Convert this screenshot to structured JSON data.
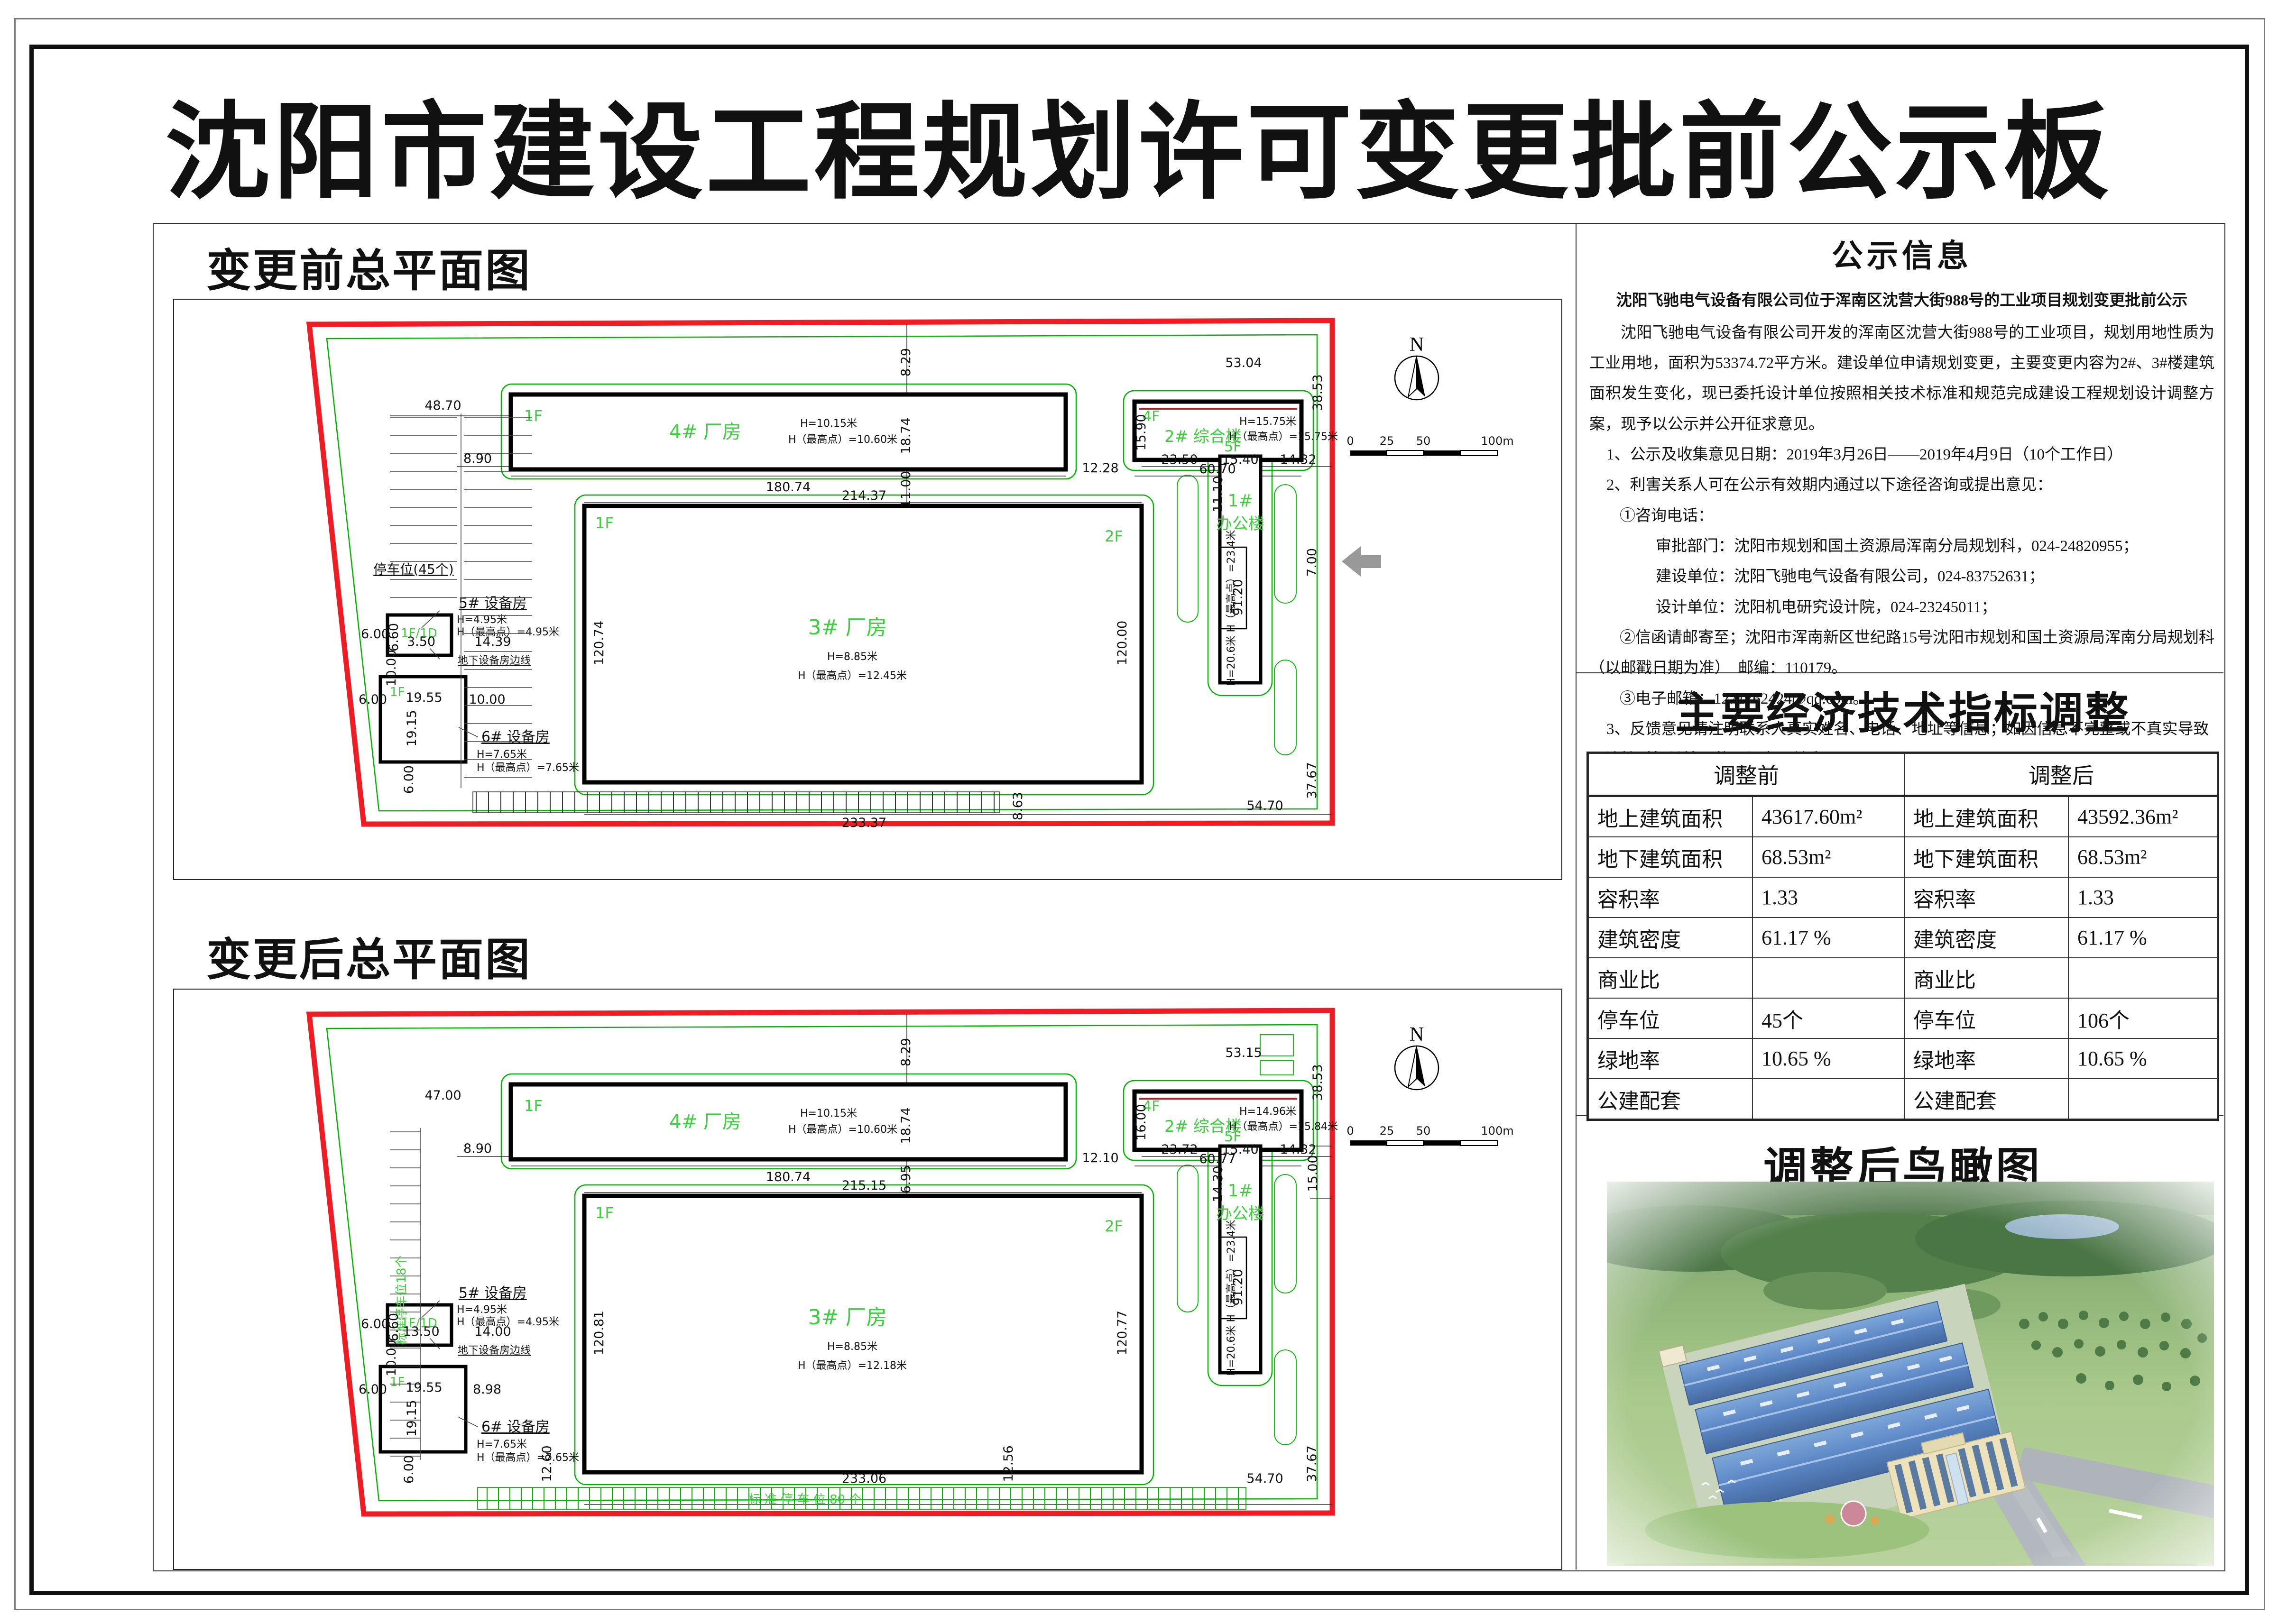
{
  "title": "沈阳市建设工程规划许可变更批前公示板",
  "plans": {
    "before_title": "变更前总平面图",
    "after_title": "变更后总平面图"
  },
  "compass": {
    "n": "N"
  },
  "scalebar": {
    "t0": "0",
    "t1": "25",
    "t2": "50",
    "t3": "100m"
  },
  "plan_before": {
    "b4_floor": "1F",
    "b4_name": "4#  厂房",
    "b4_h1": "H=10.15米",
    "b4_h2": "H（最高点）=10.60米",
    "b2_floor": "4F",
    "b2_name": "2#  综合楼",
    "b2_h1": "H=15.75米",
    "b2_h2": "H（最高点）=15.75米",
    "b3_floor_l": "1F",
    "b3_floor_r": "2F",
    "b3_name": "3#  厂房",
    "b3_h1": "H=8.85米",
    "b3_h2": "H（最高点）=12.45米",
    "b1_floor": "5F",
    "b1_no": "1#",
    "b1_name": "办公楼",
    "b1_h": "H=20.6米  H（最高点）=23.4米",
    "b5_name": "5#  设备房",
    "b5_h1": "H=4.95米",
    "b5_h2": "H（最高点）=4.95米",
    "b5_floor": "1F/1D",
    "b6_name": "6#  设备房",
    "b6_h1": "H=7.65米",
    "b6_h2": "H（最高点）=7.65米",
    "b6_floor": "1F",
    "underground": "地下设备房边线",
    "parking": "停车位(45个)",
    "dims": {
      "top_left": "48.70",
      "left": "8.90",
      "b4_w": "180.74",
      "gap24": "12.28",
      "b2_w": "60.70",
      "b2_h": "15.90",
      "v1": "8.29",
      "v2": "18.74",
      "v3": "11.00",
      "b3_top": "214.37",
      "b2_below": "11.10",
      "tr_w": "53.04",
      "tr_h": "38.53",
      "d1": "23.50",
      "d2": "15.40",
      "d3": "14.32",
      "b1_len": "91.20",
      "b3_left": "120.74",
      "b3_right": "120.00",
      "b3_bottom": "233.37",
      "br_w": "54.70",
      "br_h": "37.67",
      "b3_below": "8.63",
      "gate": "7.00",
      "e1": "6.00",
      "e2": "6.60",
      "e3": "3.50",
      "e4": "14.39",
      "e5": "10.00",
      "f1": "6.00",
      "f2": "19.55",
      "f3": "10.00",
      "f4": "19.15",
      "f5": "6.00"
    }
  },
  "plan_after": {
    "b4_floor": "1F",
    "b4_name": "4#  厂房",
    "b4_h1": "H=10.15米",
    "b4_h2": "H（最高点）=10.60米",
    "b2_floor": "4F",
    "b2_name": "2#  综合楼",
    "b2_h1": "H=14.96米",
    "b2_h2": "H（最高点）=15.84米",
    "b3_floor_l": "1F",
    "b3_floor_r": "2F",
    "b3_name": "3#  厂房",
    "b3_h1": "H=8.85米",
    "b3_h2": "H（最高点）=12.18米",
    "b1_floor": "5F",
    "b1_no": "1#",
    "b1_name": "办公楼",
    "b1_h": "H=20.6米  H（最高点）=23.4米",
    "b5_name": "5#  设备房",
    "b5_h1": "H=4.95米",
    "b5_h2": "H（最高点）=4.95米",
    "b5_floor": "1F/1D",
    "b6_name": "6#  设备房",
    "b6_h1": "H=7.65米",
    "b6_h2": "H（最高点）=7.65米",
    "b6_floor": "1F",
    "underground": "地下设备房边线",
    "parking_left": "标准停车位18个",
    "parking_bottom": "标 准 停 车 位 80 个",
    "dims": {
      "top_left": "47.00",
      "left": "8.90",
      "b4_w": "180.74",
      "gap24": "12.10",
      "b2_w": "60.77",
      "b2_h": "16.00",
      "v1": "8.29",
      "v2": "18.74",
      "v3": "6.95",
      "b3_top": "215.15",
      "b2_below": "14.30",
      "tr_w": "53.15",
      "tr_h": "38.53",
      "d1": "23.72",
      "d2": "15.40",
      "d3": "14.32",
      "b1_len": "91.20",
      "b3_left": "120.81",
      "b3_right": "120.77",
      "b3_bottom": "233.06",
      "br_w": "54.70",
      "br_h": "37.67",
      "gate": "15.00",
      "e1": "6.00",
      "e2": "6.60",
      "e3": "13.50",
      "e4": "14.00",
      "e5": "10.00",
      "f1": "6.00",
      "f2": "19.55",
      "f3": "8.98",
      "f4": "19.15",
      "f5": "6.00",
      "g1": "12.60",
      "g2": "12.56"
    }
  },
  "notice": {
    "title": "公示信息",
    "heading": "沈阳飞驰电气设备有限公司位于浑南区沈营大街988号的工业项目规划变更批前公示",
    "body": "沈阳飞驰电气设备有限公司开发的浑南区沈营大街988号的工业项目，规划用地性质为工业用地，面积为53374.72平方米。建设单位申请规划变更，主要变更内容为2#、3#楼建筑面积发生变化，现已委托设计单位按照相关技术标准和规范完成建设工程规划设计调整方案，现予以公示并公开征求意见。",
    "items": [
      "1、公示及收集意见日期：2019年3月26日——2019年4月9日（10个工作日）",
      "2、利害关系人可在公示有效期内通过以下途径咨询或提出意见：",
      "①咨询电话：",
      "审批部门：沈阳市规划和国土资源局浑南分局规划科，024-24820955；",
      "建设单位：沈阳飞驰电气设备有限公司，024-83752631；",
      "设计单位：沈阳机电研究设计院，024-23245011；",
      "②信函请邮寄至；沈阳市浑南新区世纪路15号沈阳市规划和国土资源局浑南分局规划科（以邮戳日期为准）　邮编：110179。",
      "③电子邮箱：1271762424@qq.com。",
      "3、反馈意见请注明联系人真实姓名、电话、地址等信息；如因信息不完整或不真实导致无法核对相关情况的，视为无效意见。",
      "4、本方案涉及的利害关系人依法享有听证权。"
    ],
    "signature": "沈阳市自然资源局浑南分局",
    "date": "2019年3月25日"
  },
  "econ": {
    "title": "主要经济技术指标调整",
    "col_before": "调整前",
    "col_after": "调整后",
    "rows": [
      {
        "bl": "地上建筑面积",
        "bv": "43617.60m²",
        "al": "地上建筑面积",
        "av": "43592.36m²"
      },
      {
        "bl": "地下建筑面积",
        "bv": "68.53m²",
        "al": "地下建筑面积",
        "av": "68.53m²"
      },
      {
        "bl": "容积率",
        "bv": "1.33",
        "al": "容积率",
        "av": "1.33"
      },
      {
        "bl": "建筑密度",
        "bv": "61.17 %",
        "al": "建筑密度",
        "av": "61.17 %"
      },
      {
        "bl": "商业比",
        "bv": "",
        "al": "商业比",
        "av": ""
      },
      {
        "bl": "停车位",
        "bv": "45个",
        "al": "停车位",
        "av": "106个"
      },
      {
        "bl": "绿地率",
        "bv": "10.65 %",
        "al": "绿地率",
        "av": "10.65 %"
      },
      {
        "bl": "公建配套",
        "bv": "",
        "al": "公建配套",
        "av": ""
      }
    ]
  },
  "render": {
    "title": "调整后鸟瞰图"
  }
}
